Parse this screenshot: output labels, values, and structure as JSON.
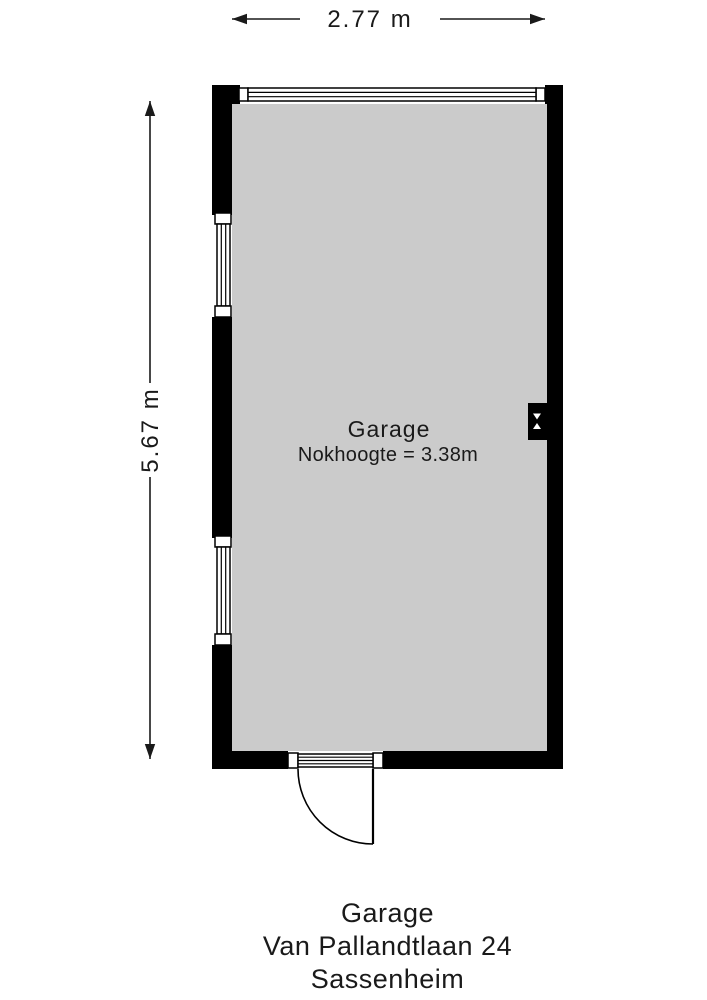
{
  "colors": {
    "wall": "#000000",
    "floor": "#cbcbcb",
    "background": "#ffffff",
    "text": "#1a1a1a"
  },
  "dimensions": {
    "width": "2.77 m",
    "height": "5.67 m"
  },
  "room": {
    "name": "Garage",
    "ridge_height": "Nokhoogte = 3.38m"
  },
  "caption": {
    "title": "Garage",
    "address": "Van Pallandtlaan 24",
    "city": "Sassenheim"
  },
  "icons": {
    "windows": "window-glazing-icon",
    "door": "door-swing-icon",
    "fixture": "wall-light-icon",
    "width_arrow": "horizontal-dimension-arrow-icon",
    "height_arrow": "vertical-dimension-arrow-icon"
  }
}
